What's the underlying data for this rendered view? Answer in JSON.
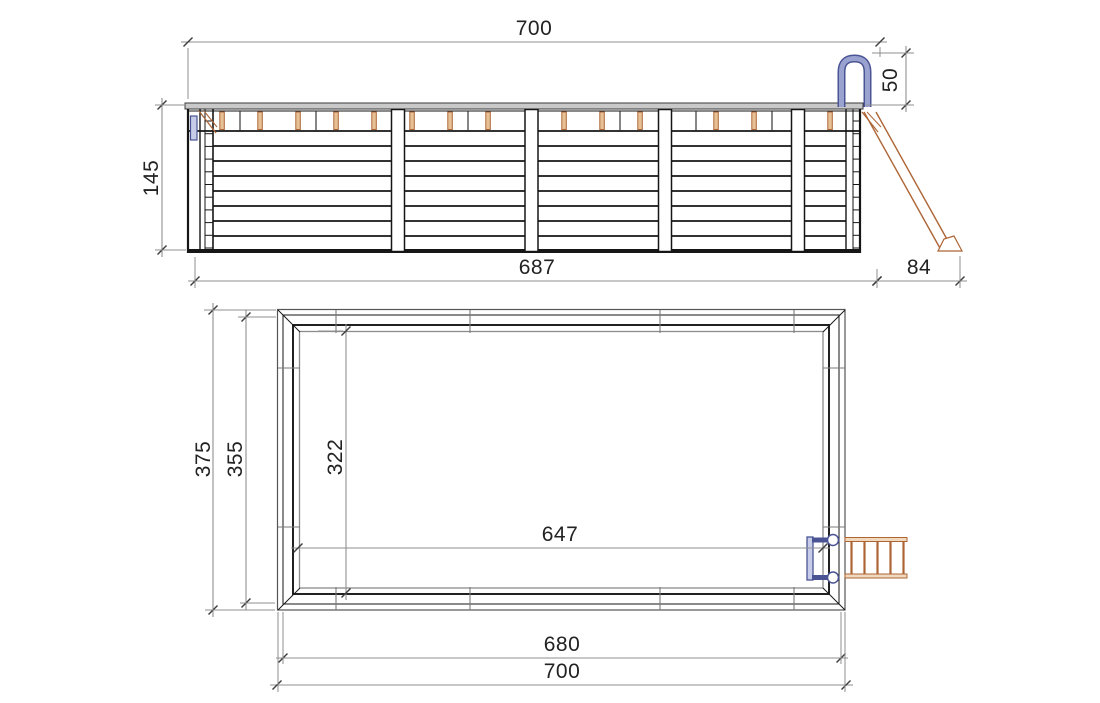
{
  "drawing": {
    "title": "wooden-pool-technical-drawing",
    "views": {
      "elevation": {
        "name": "side-elevation",
        "dims": {
          "overall_width": "700",
          "handrail_height": "50",
          "wall_height": "145",
          "wall_length": "687",
          "ladder_offset": "84"
        }
      },
      "plan": {
        "name": "plan-view",
        "dims": {
          "overall_depth": "375",
          "frame_depth": "355",
          "interior_depth": "322",
          "interior_length": "647",
          "frame_length": "680",
          "overall_length": "700"
        }
      }
    }
  },
  "colors": {
    "line": "#161616",
    "dim_line": "#8f8f8f",
    "tick": "#3d3d3d",
    "text": "#222222",
    "wood_stroke": "#ad6536",
    "wood_fill": "#e7c196",
    "wood_fill_light": "#f0d9bd",
    "steel_stroke": "#4a5494",
    "steel_fill": "#9aa3d0",
    "steel_light": "#c7cce8",
    "cap_fill": "#c9c9c9",
    "background": "#ffffff"
  }
}
